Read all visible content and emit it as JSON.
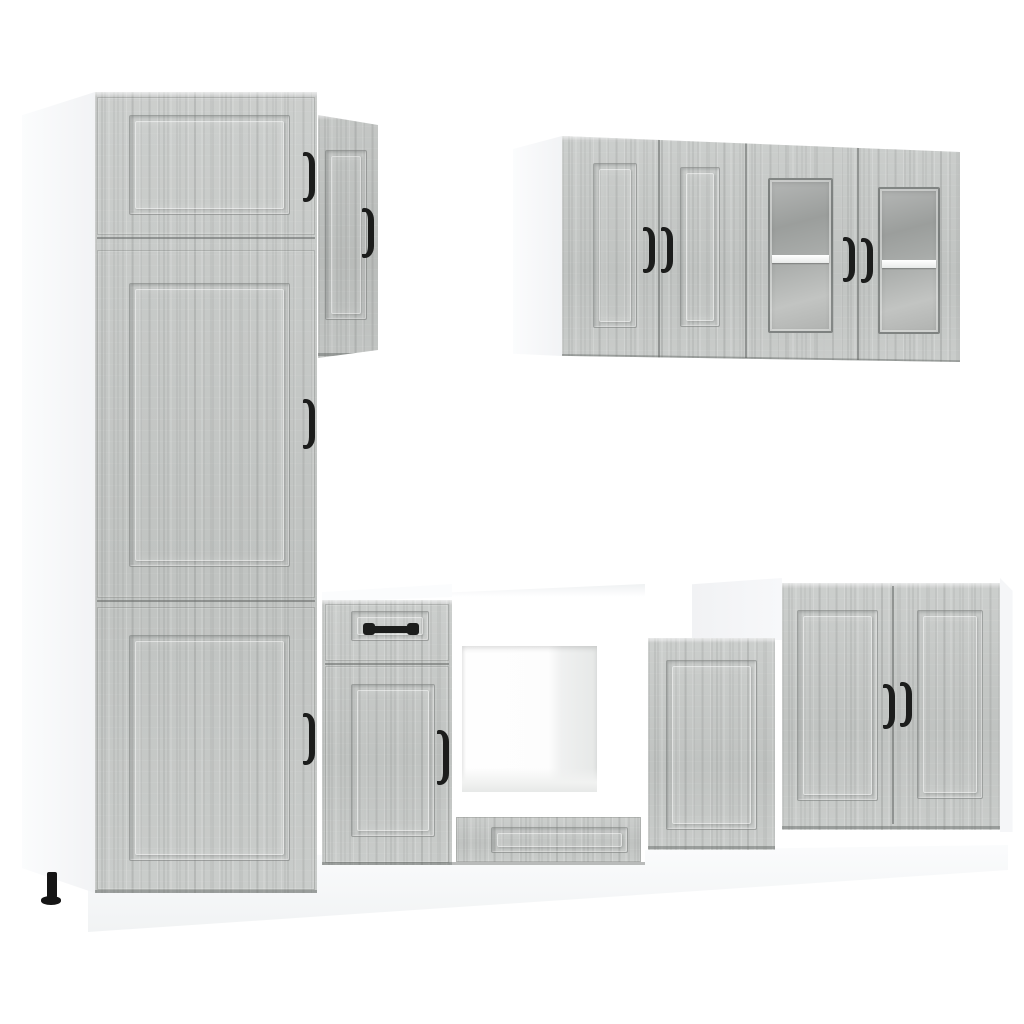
{
  "meta": {
    "label": "Product photo: 8-piece kitchen cabinet set in grey sonoma wood-look with black bow handles, white carcasses and plinth, on a plain white background"
  },
  "colors": {
    "background": "#ffffff",
    "wood": "#c6c9c7",
    "woodLight": "#dadcda",
    "woodDark": "#a9acaa",
    "carcass": "#ffffff",
    "sidePanel": "#f6f7f9",
    "glass": "#a9abaa",
    "glassLight": "#c6c8c6",
    "handle": "#1c1d1c",
    "seam": "#646866",
    "plinth": "#f5f6f7",
    "foot": "#151515"
  },
  "modules": [
    {
      "name": "tall-pantry-cabinet",
      "doors": 3,
      "handles": 3,
      "drawers": 0
    },
    {
      "name": "side-wall-cabinet",
      "doors": 1,
      "handles": 1,
      "drawers": 0
    },
    {
      "name": "upper-wall-cabinet-wood-doors",
      "doors": 2,
      "handles": 2,
      "drawers": 0
    },
    {
      "name": "upper-wall-cabinet-glass-doors",
      "doors": 2,
      "handles": 2,
      "glass_panels": 2,
      "shelves_visible": 2
    },
    {
      "name": "base-cabinet-with-drawer",
      "doors": 1,
      "handles": 2,
      "drawers": 1
    },
    {
      "name": "oven-housing-unit",
      "open_bay": true,
      "drawers": 1,
      "handles": 0
    },
    {
      "name": "small-base-cabinet",
      "doors": 1,
      "handles": 0,
      "drawers": 0
    },
    {
      "name": "double-door-base-cabinet",
      "doors": 2,
      "handles": 2,
      "drawers": 0
    },
    {
      "name": "plinth-panel"
    },
    {
      "name": "adjustable-foot"
    }
  ]
}
